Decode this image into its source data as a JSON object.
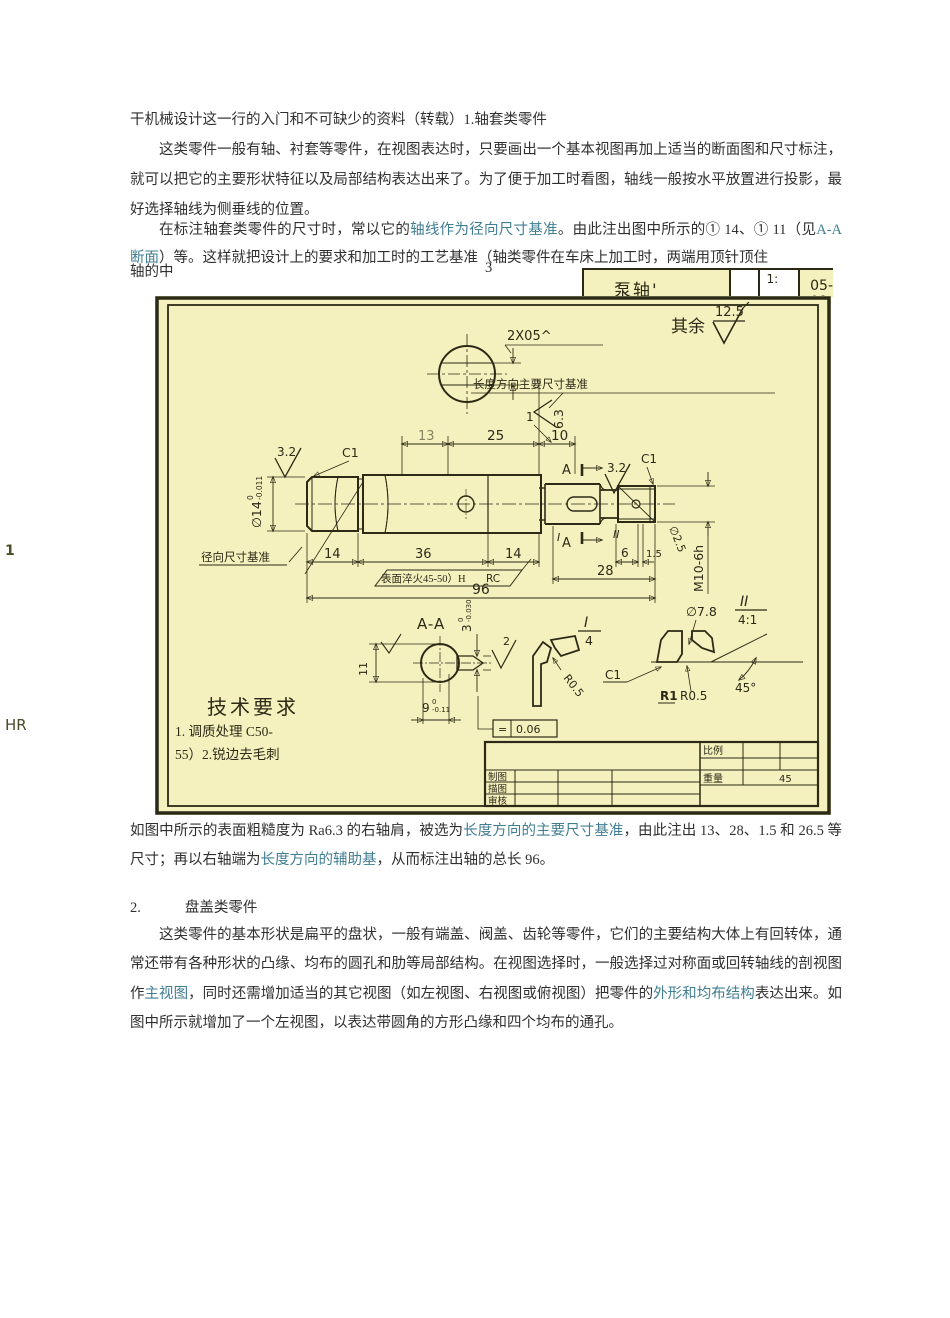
{
  "page": {
    "margin": {
      "frag1": "1",
      "frag2": "HR"
    },
    "p1": "干机械设计这一行的入门和不可缺少的资料（转载）1.轴套类零件",
    "p2": "这类零件一般有轴、衬套等零件，在视图表达时，只要画出一个基本视图再加上适当的断面图和尺寸标注，就可以把它的主要形状特征以及局部结构表达出来了。为了便于加工时看图，轴线一般按水平放置进行投影，最好选择轴线为侧垂线的位置。",
    "p3": {
      "s1": "在标注轴套类零件的尺寸时，常以它的",
      "t1": "轴线作为径向尺寸基准",
      "s2": "。由此注出图中所示的① 14、① 11（见",
      "t2": "A-A 断面",
      "s3": "）等。这样就把设计上的要求和加工时的工艺基准（轴类零件在车床上加工时，两端用顶针顶住",
      "s4": "轴的中",
      "frag3": "3"
    },
    "p4": {
      "s1": "如图中所示的表面粗糙度为 Ra6.3 的右轴肩，被选为",
      "t1": "长度方向的主要尺寸基准",
      "s2": "，由此注出 13、28、1.5 和 26.5 等尺寸；再以右轴端为",
      "t2": "长度方向的辅助基",
      "s3": "，从而标注出轴的总长 96。"
    },
    "p5_num": "2.",
    "p5_title": "盘盖类零件",
    "p6": {
      "s1": "这类零件的基本形状是扁平的盘状，一般有端盖、阀盖、齿轮等零件，它们的主要结构大体上有回转体，通常还带有各种形状的凸缘、均布的圆孔和肋等局部结构。在视图选择时，一般选择过对称面或回转轴线的剖视图作",
      "t1": "主视图",
      "s2": "，同时还需增加适当的其它视图（如左视图、右视图或俯视图）把零件的",
      "t2": "外形和均布结构",
      "s3": "表达出来。如图中所示就增加了一个左视图，以表达带圆角的方形凸缘和四个均布的通孔。"
    }
  },
  "strip": {
    "part_name": "泵轴'",
    "scale": "1:",
    "doc_no": "05-01"
  },
  "drawing": {
    "qiyu": "其余",
    "rough_corner": "12.5",
    "hole_note": "2X05^",
    "datum_note": "长度方向主要尺寸基准",
    "rough_63": "6.3",
    "rough_32_left": "3.2",
    "rough_32_right": "3.2",
    "rough_2": "2",
    "d13": "13",
    "d25": "25",
    "d10": "10",
    "d1": "1",
    "d14a": "14",
    "d36": "36",
    "d14b": "14",
    "d6": "6",
    "d15": "1.5",
    "d28": "28",
    "d96": "96",
    "c1_left": "C1",
    "c1_right": "C1",
    "dia14": "∅14",
    "dia14_tol_up": "0",
    "dia14_tol_dn": "-0.011",
    "radial_datum": "径向尺寸基准",
    "surface_note": "表面淬火45-50）H",
    "surface_note2": "RC",
    "m10": "M10-6h",
    "dia_hole": "∅2.5",
    "sec_a1": "A",
    "sec_a2": "A",
    "mk1": "I",
    "mk2": "II",
    "aa_title": "A-A",
    "key_w": "3",
    "key_w_up": "0",
    "key_w_dn": "-0.030",
    "key_d": "9",
    "key_d_up": "0",
    "key_d_dn": "-0.11",
    "d11": "11",
    "fcf_sym": "=",
    "fcf_val": "0.06",
    "det1_num": "I",
    "det1_den": "4",
    "det2_num": "II",
    "det2_den": "4:1",
    "r05_a": "R0.5",
    "r05_b": "R0.5",
    "r1": "R1",
    "c1_det": "C1",
    "deg45": "45°",
    "dia78": "∅7.8",
    "tech_title": "技术要求",
    "tech_1": "1. 调质处理 C50-",
    "tech_2": "55）2.锐边去毛刺",
    "tb_bili": "比例",
    "tb_zhongliang": "重量",
    "tb_weight": "45",
    "tb_zhitu": "制图",
    "tb_miaotu": "描图",
    "tb_shenhe": "审核"
  }
}
